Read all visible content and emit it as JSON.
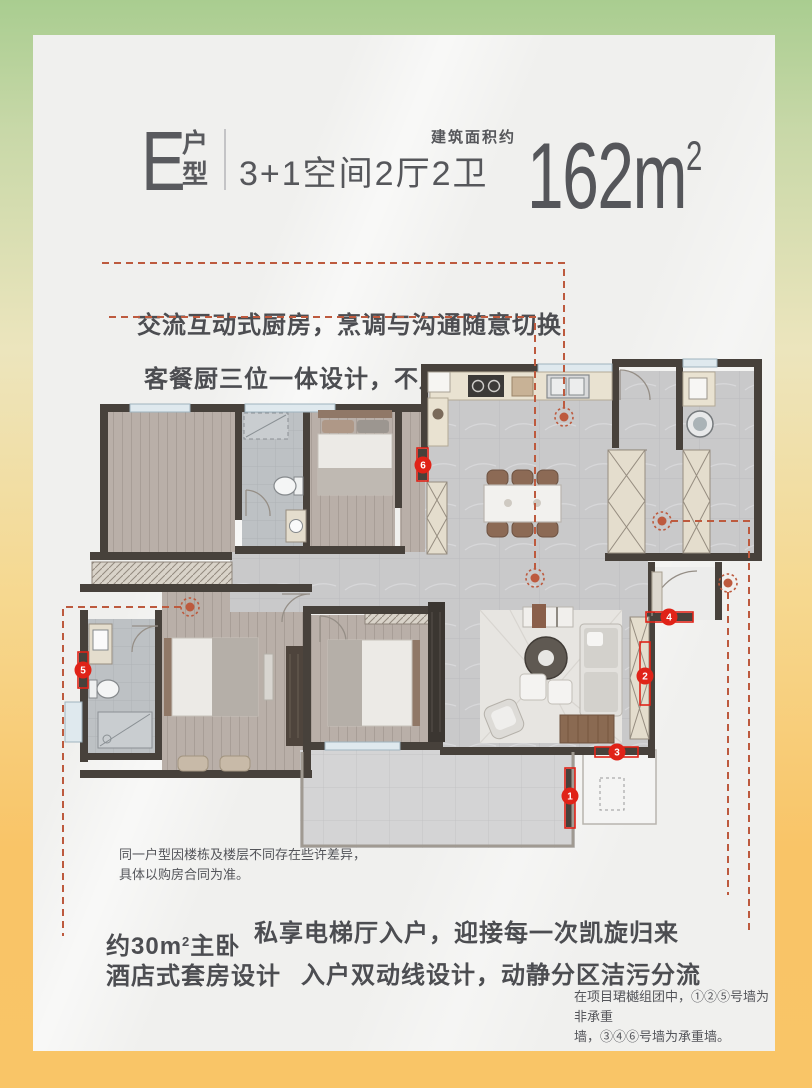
{
  "header": {
    "unit_letter": "E",
    "unit_type_top": "户",
    "unit_type_bottom": "型",
    "layout_spec": "3+1空间2厅2卫",
    "area_label": "建筑面积约",
    "area_number": "162m",
    "area_superscript": "2"
  },
  "kitchen_callout": {
    "line1": "交流互动式厨房，烹调与沟通随意切换",
    "line2": "客餐厨三位一体设计，不凡品质与气度"
  },
  "master_callout": {
    "line1_prefix": "约30m",
    "line1_sup": "2",
    "line1_suffix": "主卧",
    "line2": "酒店式套房设计"
  },
  "entry_callout": {
    "line1": "私享电梯厅入户，迎接每一次凯旋归来",
    "line2": "入户双动线设计，动静分区洁污分流"
  },
  "plan_note": {
    "line1": "同一户型因楼栋及楼层不同存在些许差异，",
    "line2": "具体以购房合同为准。"
  },
  "wall_note": {
    "line1": "在项目珺樾组团中，①②⑤号墙为非承重",
    "line2": "墙，③④⑥号墙为承重墙。"
  },
  "floorplan": {
    "marker_numbers": [
      "1",
      "2",
      "3",
      "4",
      "5",
      "6"
    ]
  },
  "colors": {
    "frame_gradient_top": "#a9cd90",
    "frame_gradient_bottom": "#f9c567",
    "card_background": "#f0f0ee",
    "heading_text": "#56575b",
    "caption_text": "#4c4d51",
    "wall": "#47413b",
    "accent_red": "#e02318",
    "leader_line": "#bd5a3e",
    "wood_floor": "#b9afa8",
    "tile_floor": "#c9c9ca"
  }
}
